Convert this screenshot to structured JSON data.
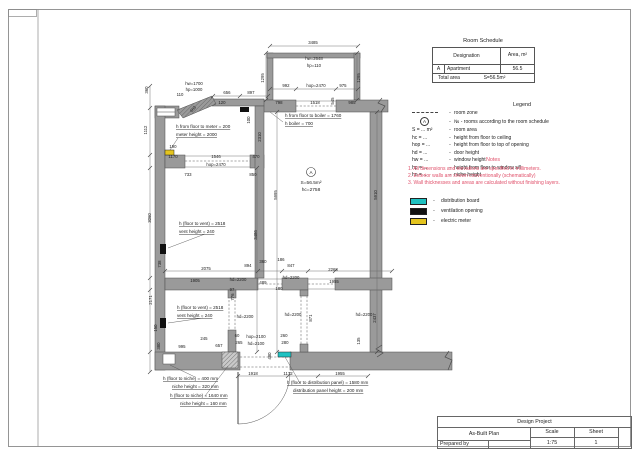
{
  "colors": {
    "wall": "#9a9a9a",
    "wall_stroke": "#4d4d4d",
    "line": "#666666",
    "text": "#222222",
    "notes": "#e0506a",
    "distribution_board": "#1fc2c2",
    "electric_meter": "#e4c41e",
    "ventilation": "#111111",
    "frame": "#8a8a8a"
  },
  "schedule": {
    "title": "Room Schedule",
    "col_designation": "Designation",
    "col_area": "Area, m²",
    "row": {
      "id": "A",
      "name": "Apartment",
      "area": "56.5"
    },
    "total_label": "Total area",
    "total_value": "S=56.5m²"
  },
  "legend": {
    "title": "Legend",
    "items": [
      {
        "sym": "dash",
        "txt": "room zone"
      },
      {
        "sym": "circle",
        "circle_text": "A",
        "txt": "№ - rooms according to the room schedule"
      },
      {
        "pre": "S = ... m²",
        "txt": "room area"
      },
      {
        "pre": "hc = ...",
        "txt": "height from floor to ceiling"
      },
      {
        "pre": "hop = ...",
        "txt": "height from floor to top of opening"
      },
      {
        "pre": "hd = ...",
        "txt": "door height"
      },
      {
        "pre": "hw = ...",
        "txt": "window height"
      },
      {
        "pre": "hp = ...",
        "txt": "height from floor to window sill"
      },
      {
        "pre": "hn = ...",
        "txt": "niche height"
      }
    ]
  },
  "notes": {
    "title": "Notes",
    "items": [
      "1. All dimensions and elevations are specified in millimeters.",
      "2. Exterior walls are shown conventionally (schematically)",
      "3. Wall thicknesses and areas are calculated without finishing layers."
    ]
  },
  "symbols": [
    {
      "name": "distribution-board",
      "color": "#1fc2c2",
      "label": "distribution board"
    },
    {
      "name": "ventilation-opening",
      "color": "#111111",
      "label": "ventilation opening"
    },
    {
      "name": "electric-meter",
      "color": "#e4c41e",
      "label": "electric meter"
    }
  ],
  "titleblock": {
    "project": "Design Project",
    "drawing": "As-Built Plan",
    "scale_label": "Scale",
    "scale_value": "1:75",
    "sheet_label": "Sheet",
    "sheet_value": "1",
    "prepared_by": "Prepared by"
  },
  "plan": {
    "room": {
      "id": "A",
      "area": "S=56.5m²",
      "height": "hc=2758"
    },
    "dimensions": [
      {
        "t": "3485",
        "x": 313,
        "y": 44
      },
      {
        "t": "hw=2648",
        "x": 314,
        "y": 60
      },
      {
        "t": "hp=110",
        "x": 314,
        "y": 67
      },
      {
        "t": "1295",
        "x": 264,
        "y": 78,
        "r": -90
      },
      {
        "t": "1295",
        "x": 360,
        "y": 78,
        "r": -90
      },
      {
        "t": "992",
        "x": 286,
        "y": 87
      },
      {
        "t": "hop=2470",
        "x": 316,
        "y": 87
      },
      {
        "t": "975",
        "x": 343,
        "y": 87
      },
      {
        "t": "798",
        "x": 279,
        "y": 104
      },
      {
        "t": "1518",
        "x": 315,
        "y": 104
      },
      {
        "t": "545",
        "x": 334,
        "y": 101,
        "r": -90
      },
      {
        "t": "985",
        "x": 352,
        "y": 104
      },
      {
        "t": "hw=1700",
        "x": 194,
        "y": 85
      },
      {
        "t": "hp=1000",
        "x": 194,
        "y": 91
      },
      {
        "t": "110",
        "x": 180,
        "y": 96
      },
      {
        "t": "656",
        "x": 227,
        "y": 94
      },
      {
        "t": "897",
        "x": 251,
        "y": 94
      },
      {
        "t": "120",
        "x": 222,
        "y": 104
      },
      {
        "t": "663",
        "x": 194,
        "y": 110,
        "r": -48
      },
      {
        "t": "360",
        "x": 148,
        "y": 90,
        "r": -90
      },
      {
        "t": "1112",
        "x": 147,
        "y": 130,
        "r": -90
      },
      {
        "t": "190",
        "x": 173,
        "y": 148
      },
      {
        "t": "100",
        "x": 250,
        "y": 120,
        "r": -90
      },
      {
        "t": "2310",
        "x": 261,
        "y": 137,
        "r": -90
      },
      {
        "t": "1170",
        "x": 173,
        "y": 158
      },
      {
        "t": "1546",
        "x": 216,
        "y": 158
      },
      {
        "t": "470",
        "x": 256,
        "y": 158
      },
      {
        "t": "hop=2470",
        "x": 216,
        "y": 166
      },
      {
        "t": "733",
        "x": 188,
        "y": 176
      },
      {
        "t": "850",
        "x": 253,
        "y": 176
      },
      {
        "t": "3060",
        "x": 151,
        "y": 218,
        "r": -90
      },
      {
        "t": "3486",
        "x": 257,
        "y": 235,
        "r": -90
      },
      {
        "t": "5995",
        "x": 277,
        "y": 195,
        "r": -90
      },
      {
        "t": "5910",
        "x": 377,
        "y": 195,
        "r": -90
      },
      {
        "t": "738",
        "x": 161,
        "y": 264,
        "r": -90
      },
      {
        "t": "2075",
        "x": 206,
        "y": 270
      },
      {
        "t": "894",
        "x": 248,
        "y": 267
      },
      {
        "t": "360",
        "x": 263,
        "y": 263
      },
      {
        "t": "186",
        "x": 281,
        "y": 261
      },
      {
        "t": "847",
        "x": 291,
        "y": 267
      },
      {
        "t": "2268",
        "x": 333,
        "y": 271
      },
      {
        "t": "1955",
        "x": 334,
        "y": 283
      },
      {
        "t": "1905",
        "x": 195,
        "y": 282
      },
      {
        "t": "hd=2200",
        "x": 238,
        "y": 281
      },
      {
        "t": "97",
        "x": 232,
        "y": 291
      },
      {
        "t": "489",
        "x": 263,
        "y": 284
      },
      {
        "t": "hd=2200",
        "x": 291,
        "y": 279
      },
      {
        "t": "180",
        "x": 279,
        "y": 290
      },
      {
        "t": "776",
        "x": 234,
        "y": 297,
        "r": -90
      },
      {
        "t": "2171",
        "x": 152,
        "y": 300,
        "r": -90
      },
      {
        "t": "hd=2200",
        "x": 245,
        "y": 318
      },
      {
        "t": "hd=2200",
        "x": 293,
        "y": 316
      },
      {
        "t": "hd=2200",
        "x": 364,
        "y": 316
      },
      {
        "t": "871",
        "x": 312,
        "y": 318,
        "r": -90
      },
      {
        "t": "2437",
        "x": 376,
        "y": 318,
        "r": -90
      },
      {
        "t": "150",
        "x": 157,
        "y": 328,
        "r": -90
      },
      {
        "t": "380",
        "x": 160,
        "y": 346,
        "r": -90
      },
      {
        "t": "245",
        "x": 204,
        "y": 340
      },
      {
        "t": "995",
        "x": 182,
        "y": 348
      },
      {
        "t": "657",
        "x": 219,
        "y": 347
      },
      {
        "t": "60",
        "x": 237,
        "y": 337
      },
      {
        "t": "265",
        "x": 239,
        "y": 344
      },
      {
        "t": "hop=2100",
        "x": 256,
        "y": 338
      },
      {
        "t": "hd=2100",
        "x": 256,
        "y": 345
      },
      {
        "t": "260",
        "x": 284,
        "y": 337
      },
      {
        "t": "280",
        "x": 285,
        "y": 344
      },
      {
        "t": "480",
        "x": 271,
        "y": 356,
        "r": -90
      },
      {
        "t": "135",
        "x": 360,
        "y": 341,
        "r": -90
      },
      {
        "t": "1918",
        "x": 253,
        "y": 375
      },
      {
        "t": "1172",
        "x": 288,
        "y": 375
      },
      {
        "t": "1955",
        "x": 340,
        "y": 375
      }
    ],
    "annotations": [
      {
        "t": "h from floor to meter = 200",
        "x": 176,
        "y": 128
      },
      {
        "t": "meter height = 2000",
        "x": 176,
        "y": 136
      },
      {
        "t": "h from floor to boiler = 1760",
        "x": 285,
        "y": 117
      },
      {
        "t": "h boiler = 700",
        "x": 285,
        "y": 125
      },
      {
        "t": "h (floor to vent) = 2518",
        "x": 179,
        "y": 225
      },
      {
        "t": "vent height = 240",
        "x": 179,
        "y": 233
      },
      {
        "t": "h (floor to vent) = 2518",
        "x": 177,
        "y": 309
      },
      {
        "t": "vent height = 240",
        "x": 177,
        "y": 317
      },
      {
        "t": "h (floor to niche) = 400 mm",
        "x": 163,
        "y": 380
      },
      {
        "t": "niche height = 320 mm",
        "x": 172,
        "y": 388
      },
      {
        "t": "h (floor to niche) = 1640 mm",
        "x": 170,
        "y": 397
      },
      {
        "t": "niche height = 160 mm",
        "x": 180,
        "y": 405
      },
      {
        "t": "h (floor to distribution panel) = 1580 mm",
        "x": 287,
        "y": 384
      },
      {
        "t": "distribution panel height = 200 mm",
        "x": 293,
        "y": 392
      }
    ]
  }
}
